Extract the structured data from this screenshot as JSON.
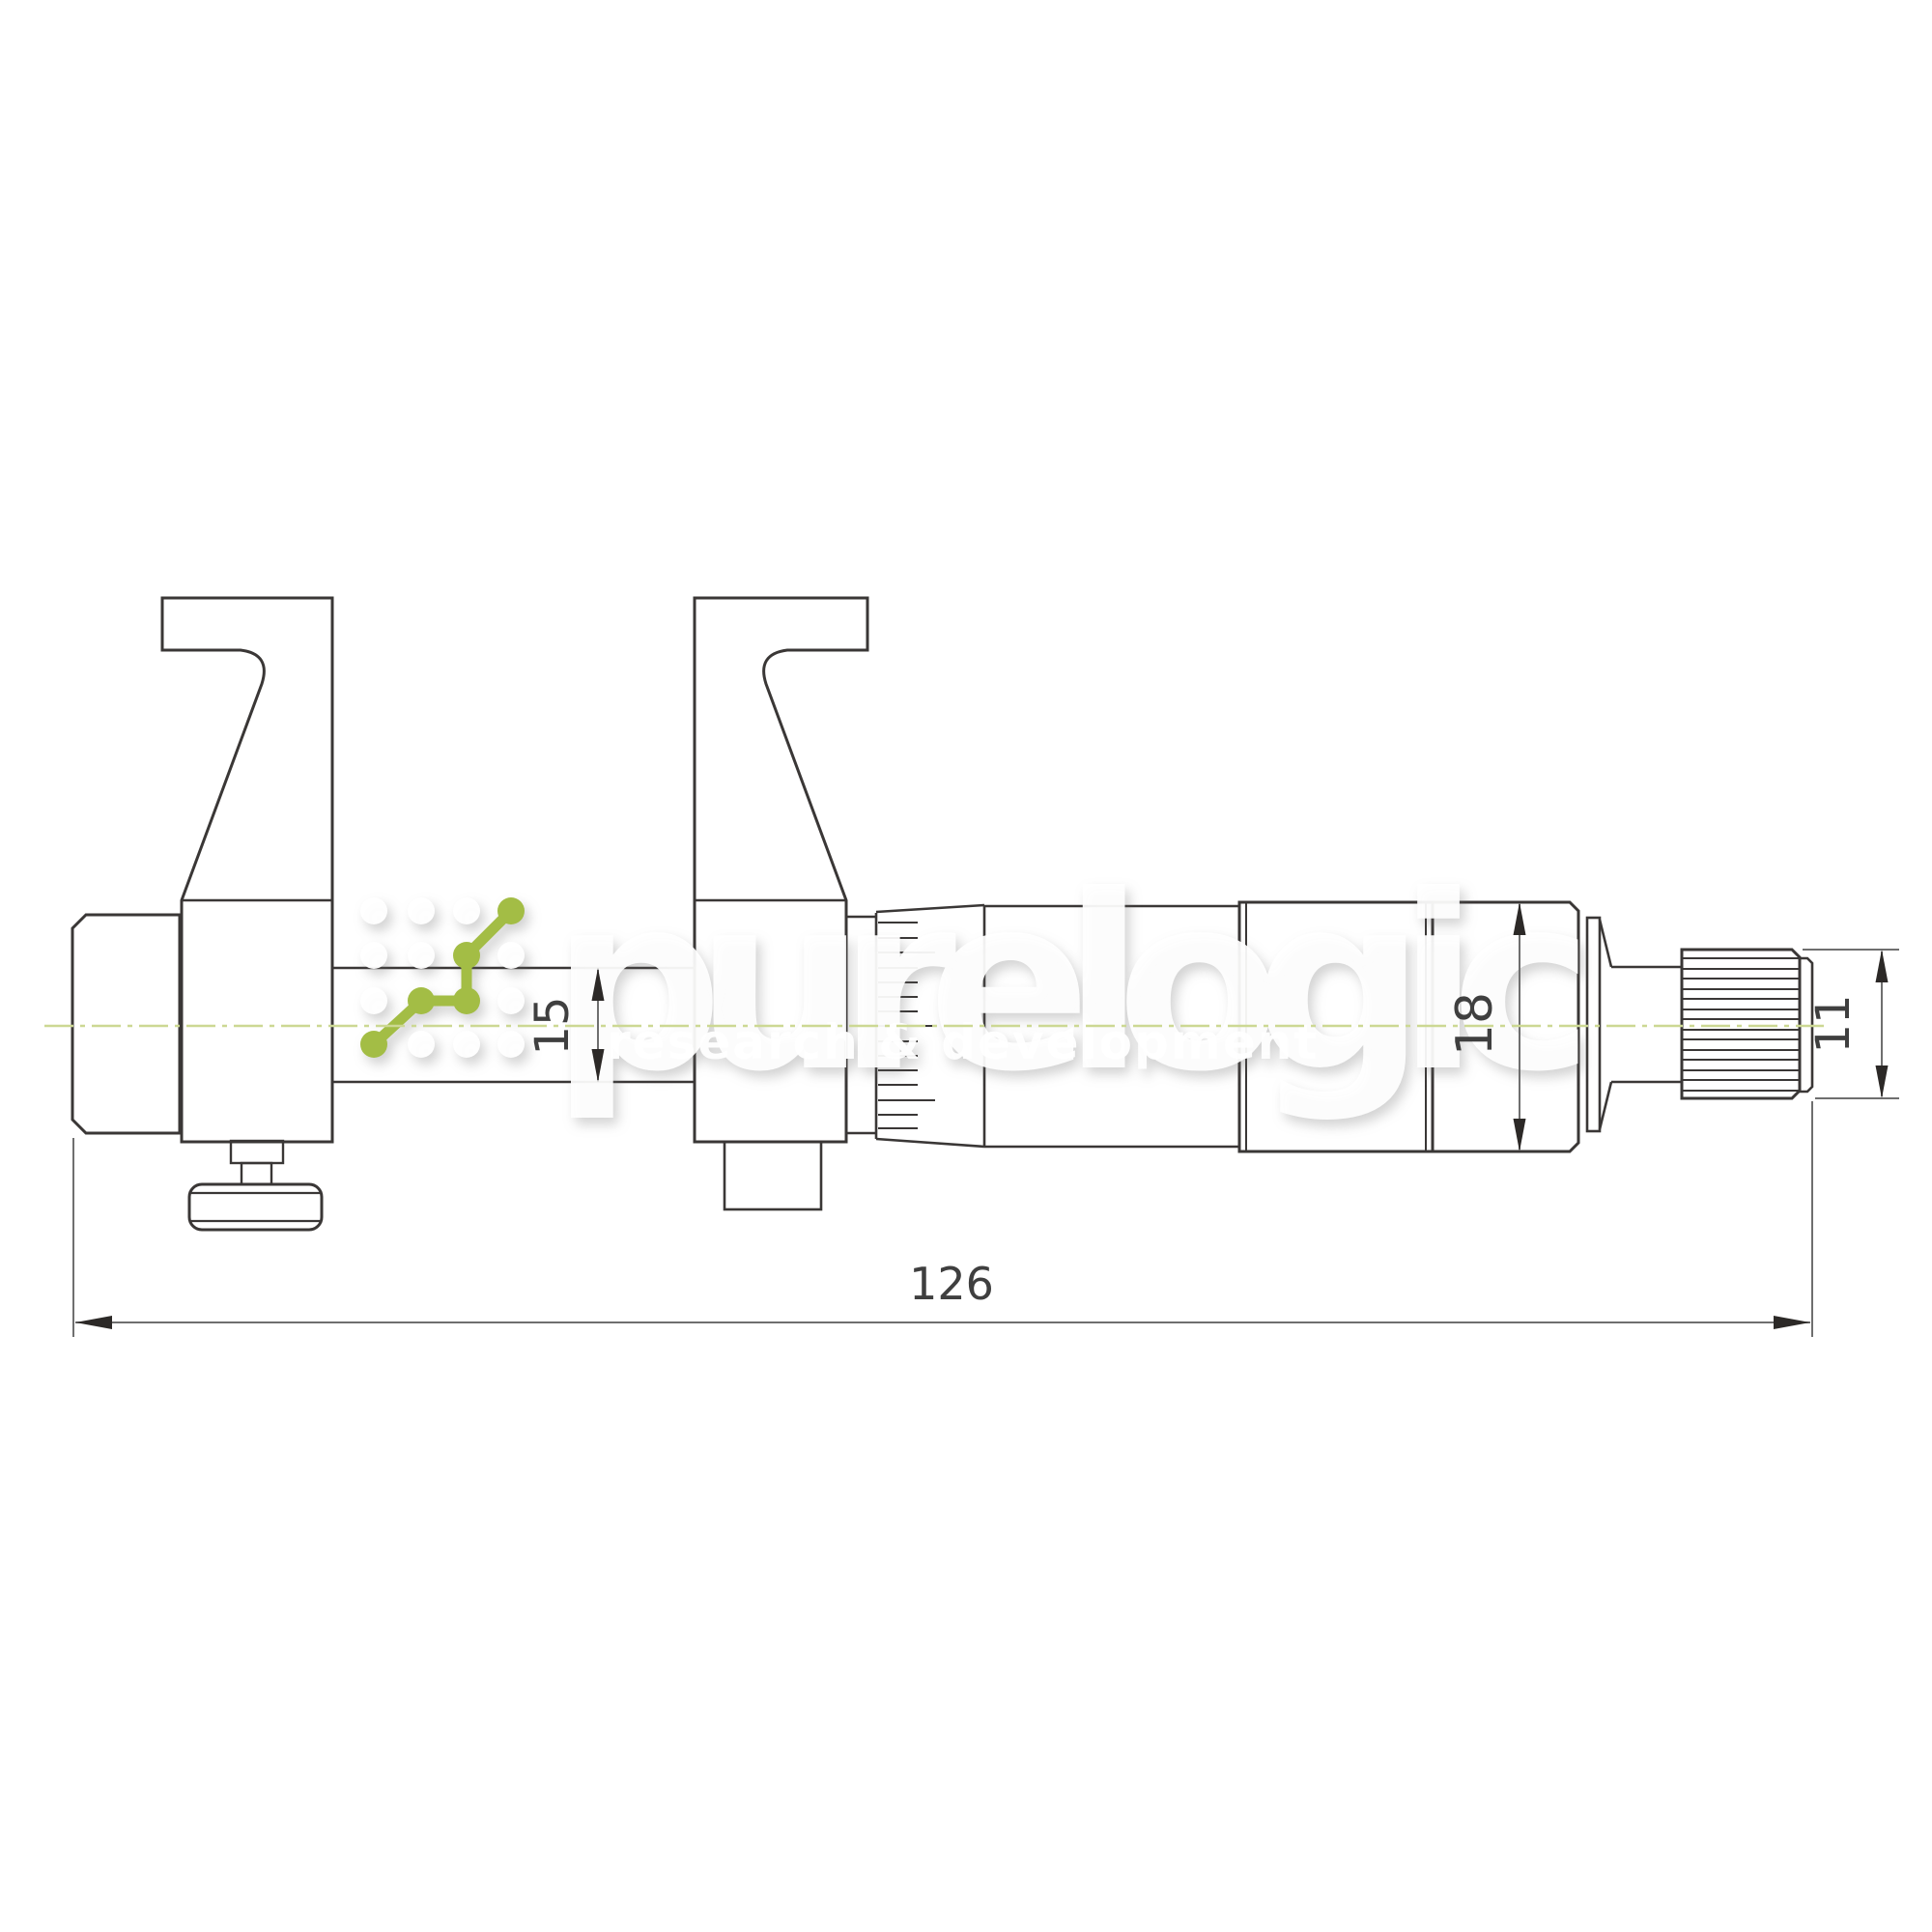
{
  "watermark": {
    "brand": "purelogic",
    "tagline": "research & development"
  },
  "dimensions": {
    "overall_length": "126",
    "rod_diameter": "15",
    "sleeve_diameter": "18",
    "ratchet_diameter": "11"
  },
  "colors": {
    "line": "#3a3736",
    "dim_line": "#6f6f6f",
    "dim_text": "#3f3f3f",
    "arrow": "#2c2927",
    "centerline": "#ccd893",
    "accent": "#a3bd45",
    "watermark": "#ffffff",
    "background": "#ffffff"
  }
}
